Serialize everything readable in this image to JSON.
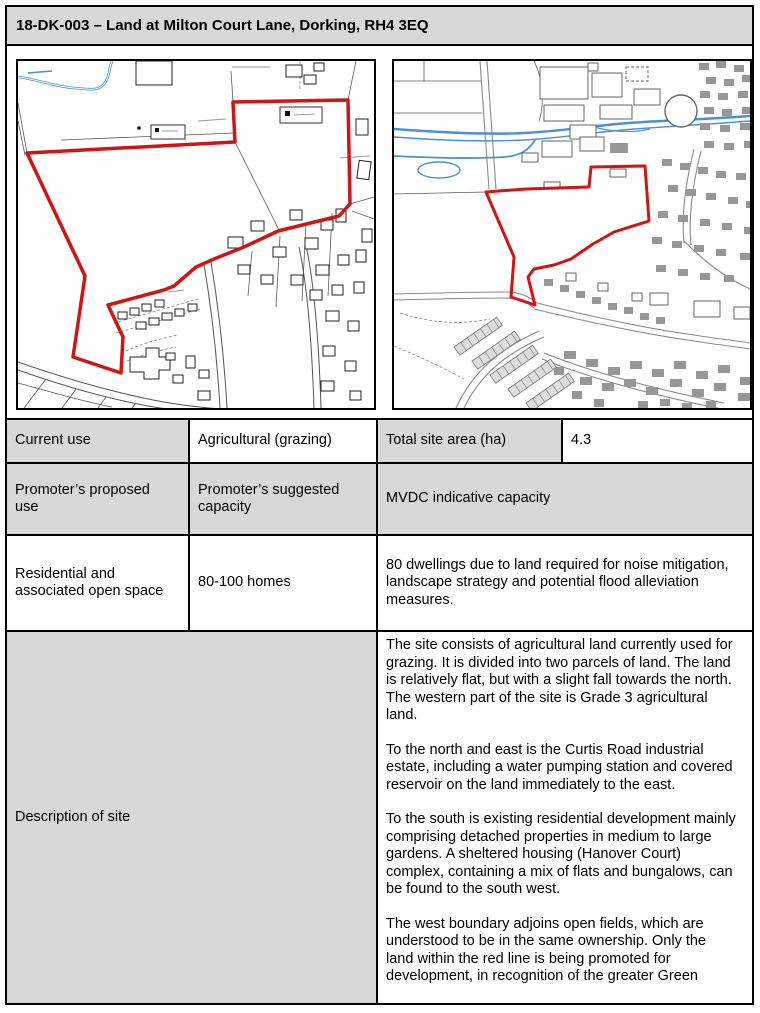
{
  "title": "18-DK-003 – Land at Milton Court Lane, Dorking, RH4 3EQ",
  "table": {
    "row1": {
      "current_use_label": "Current use",
      "current_use_value": "Agricultural (grazing)",
      "total_site_area_label": "Total site area (ha)",
      "total_site_area_value": "4.3"
    },
    "row2": {
      "proposed_use_label": "Promoter’s proposed use",
      "suggested_capacity_label": "Promoter’s suggested capacity",
      "mvdc_capacity_label": "MVDC indicative capacity"
    },
    "row3": {
      "proposed_use_value": "Residential and associated open space",
      "suggested_capacity_value": "80-100 homes",
      "mvdc_capacity_value": "80 dwellings due to land required for noise mitigation, landscape strategy and potential flood alleviation measures."
    },
    "description": {
      "label": "Description of site",
      "paragraphs": [
        "The site consists of agricultural land currently used for grazing. It is divided into two parcels of land. The land is relatively flat, but with a slight fall towards the north.  The western part of the site is Grade 3 agricultural land.",
        "To the north and east is the Curtis Road industrial estate, including a water pumping station and covered reservoir on the land immediately to the east.",
        "To the south is existing residential development mainly comprising detached properties in medium to large gardens. A sheltered housing (Hanover Court) complex, containing a mix of flats and bungalows, can be found to the south west.",
        "The west boundary adjoins open fields, which are understood to be in the same ownership. Only the land within the red line is being promoted for development, in recognition of the greater Green"
      ]
    }
  },
  "colors": {
    "header_fill": "#d8d8d8",
    "shaded_cell_fill": "#d8d8d8",
    "table_border": "#000000",
    "site_boundary_red": "#d11414",
    "water_blue": "#4a90d2"
  }
}
